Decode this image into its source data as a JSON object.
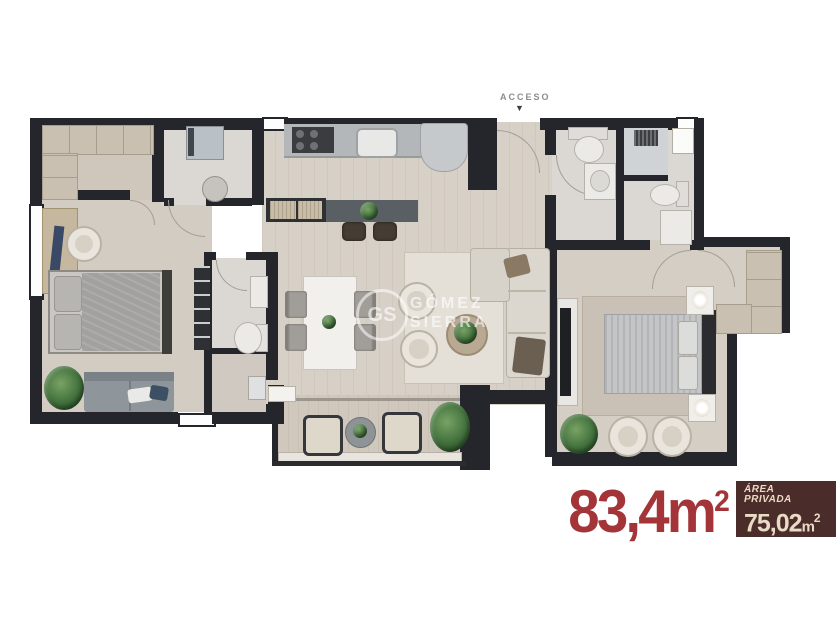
{
  "access": {
    "label": "ACCESO",
    "arrow": "▼"
  },
  "watermark": {
    "monogram": "GS",
    "name_line1": "GÓMEZ",
    "name_line2": "SIERRA"
  },
  "area_total": {
    "value": "83,4",
    "unit": "m",
    "exponent": "2"
  },
  "area_private": {
    "label_line1": "ÁREA",
    "label_line2": "PRIVADA",
    "value": "75,02",
    "unit": "m",
    "exponent": "2"
  },
  "colors": {
    "accent_red": "#a33539",
    "badge_bg": "#4a2c2b",
    "badge_text": "#eadbc4",
    "wall_dark": "#24262b",
    "floor_main": "#d7d0c7",
    "floor_bath": "#dbd8d4",
    "floor_balcony": "#d0c8bd"
  }
}
